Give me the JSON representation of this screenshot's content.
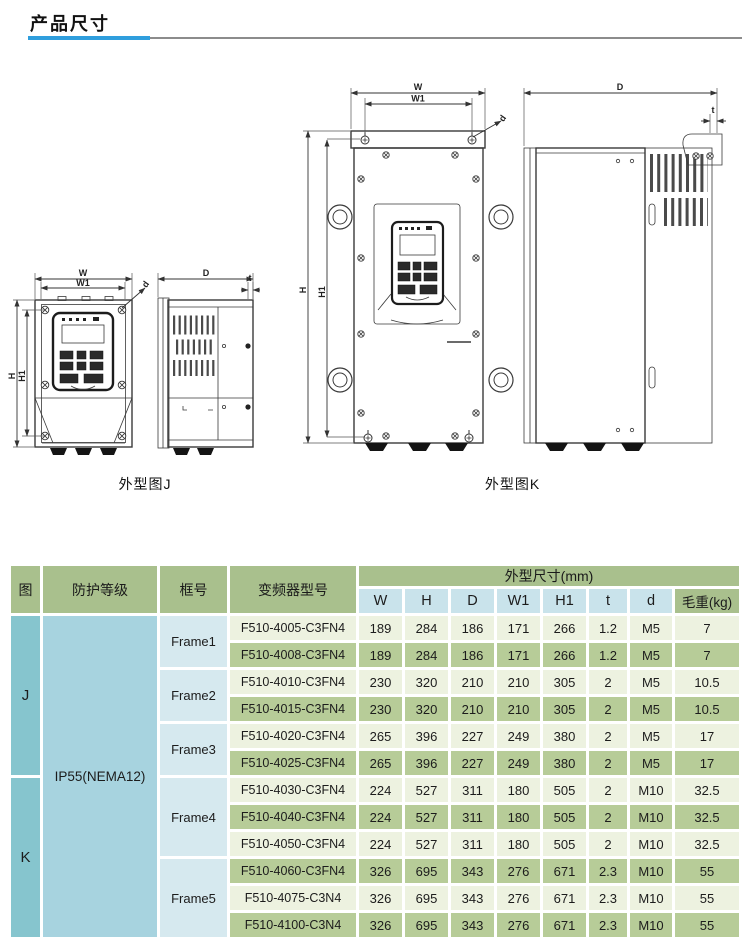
{
  "page": {
    "title": "产品尺寸"
  },
  "figures": {
    "j": {
      "caption": "外型图J",
      "labels": {
        "w": "W",
        "w1": "W1",
        "h": "H",
        "h1": "H1",
        "depth": "D",
        "t": "t",
        "hole": "d"
      }
    },
    "k": {
      "caption": "外型图K",
      "labels": {
        "w": "W",
        "w1": "W1",
        "h": "H",
        "h1": "H1",
        "depth": "D",
        "t": "t",
        "hole": "d"
      }
    }
  },
  "table": {
    "headers": {
      "fig": "图",
      "protection": "防护等级",
      "frame": "框号",
      "model": "变频器型号",
      "dims_group": "外型尺寸(mm)",
      "w": "W",
      "h": "H",
      "d": "D",
      "w1": "W1",
      "h1": "H1",
      "t": "t",
      "dia": "d",
      "weight": "毛重(kg)"
    },
    "fig_j": "J",
    "fig_k": "K",
    "protection": "IP55(NEMA12)",
    "frames": [
      "Frame1",
      "Frame2",
      "Frame3",
      "Frame4",
      "Frame5"
    ],
    "rows": [
      {
        "model": "F510-4005-C3FN4",
        "w": "189",
        "h": "284",
        "d": "186",
        "w1": "171",
        "h1": "266",
        "t": "1.2",
        "dia": "M5",
        "weight": "7"
      },
      {
        "model": "F510-4008-C3FN4",
        "w": "189",
        "h": "284",
        "d": "186",
        "w1": "171",
        "h1": "266",
        "t": "1.2",
        "dia": "M5",
        "weight": "7"
      },
      {
        "model": "F510-4010-C3FN4",
        "w": "230",
        "h": "320",
        "d": "210",
        "w1": "210",
        "h1": "305",
        "t": "2",
        "dia": "M5",
        "weight": "10.5"
      },
      {
        "model": "F510-4015-C3FN4",
        "w": "230",
        "h": "320",
        "d": "210",
        "w1": "210",
        "h1": "305",
        "t": "2",
        "dia": "M5",
        "weight": "10.5"
      },
      {
        "model": "F510-4020-C3FN4",
        "w": "265",
        "h": "396",
        "d": "227",
        "w1": "249",
        "h1": "380",
        "t": "2",
        "dia": "M5",
        "weight": "17"
      },
      {
        "model": "F510-4025-C3FN4",
        "w": "265",
        "h": "396",
        "d": "227",
        "w1": "249",
        "h1": "380",
        "t": "2",
        "dia": "M5",
        "weight": "17"
      },
      {
        "model": "F510-4030-C3FN4",
        "w": "224",
        "h": "527",
        "d": "311",
        "w1": "180",
        "h1": "505",
        "t": "2",
        "dia": "M10",
        "weight": "32.5"
      },
      {
        "model": "F510-4040-C3FN4",
        "w": "224",
        "h": "527",
        "d": "311",
        "w1": "180",
        "h1": "505",
        "t": "2",
        "dia": "M10",
        "weight": "32.5"
      },
      {
        "model": "F510-4050-C3FN4",
        "w": "224",
        "h": "527",
        "d": "311",
        "w1": "180",
        "h1": "505",
        "t": "2",
        "dia": "M10",
        "weight": "32.5"
      },
      {
        "model": "F510-4060-C3FN4",
        "w": "326",
        "h": "695",
        "d": "343",
        "w1": "276",
        "h1": "671",
        "t": "2.3",
        "dia": "M10",
        "weight": "55"
      },
      {
        "model": "F510-4075-C3N4",
        "w": "326",
        "h": "695",
        "d": "343",
        "w1": "276",
        "h1": "671",
        "t": "2.3",
        "dia": "M10",
        "weight": "55"
      },
      {
        "model": "F510-4100-C3N4",
        "w": "326",
        "h": "695",
        "d": "343",
        "w1": "276",
        "h1": "671",
        "t": "2.3",
        "dia": "M10",
        "weight": "55"
      }
    ]
  }
}
